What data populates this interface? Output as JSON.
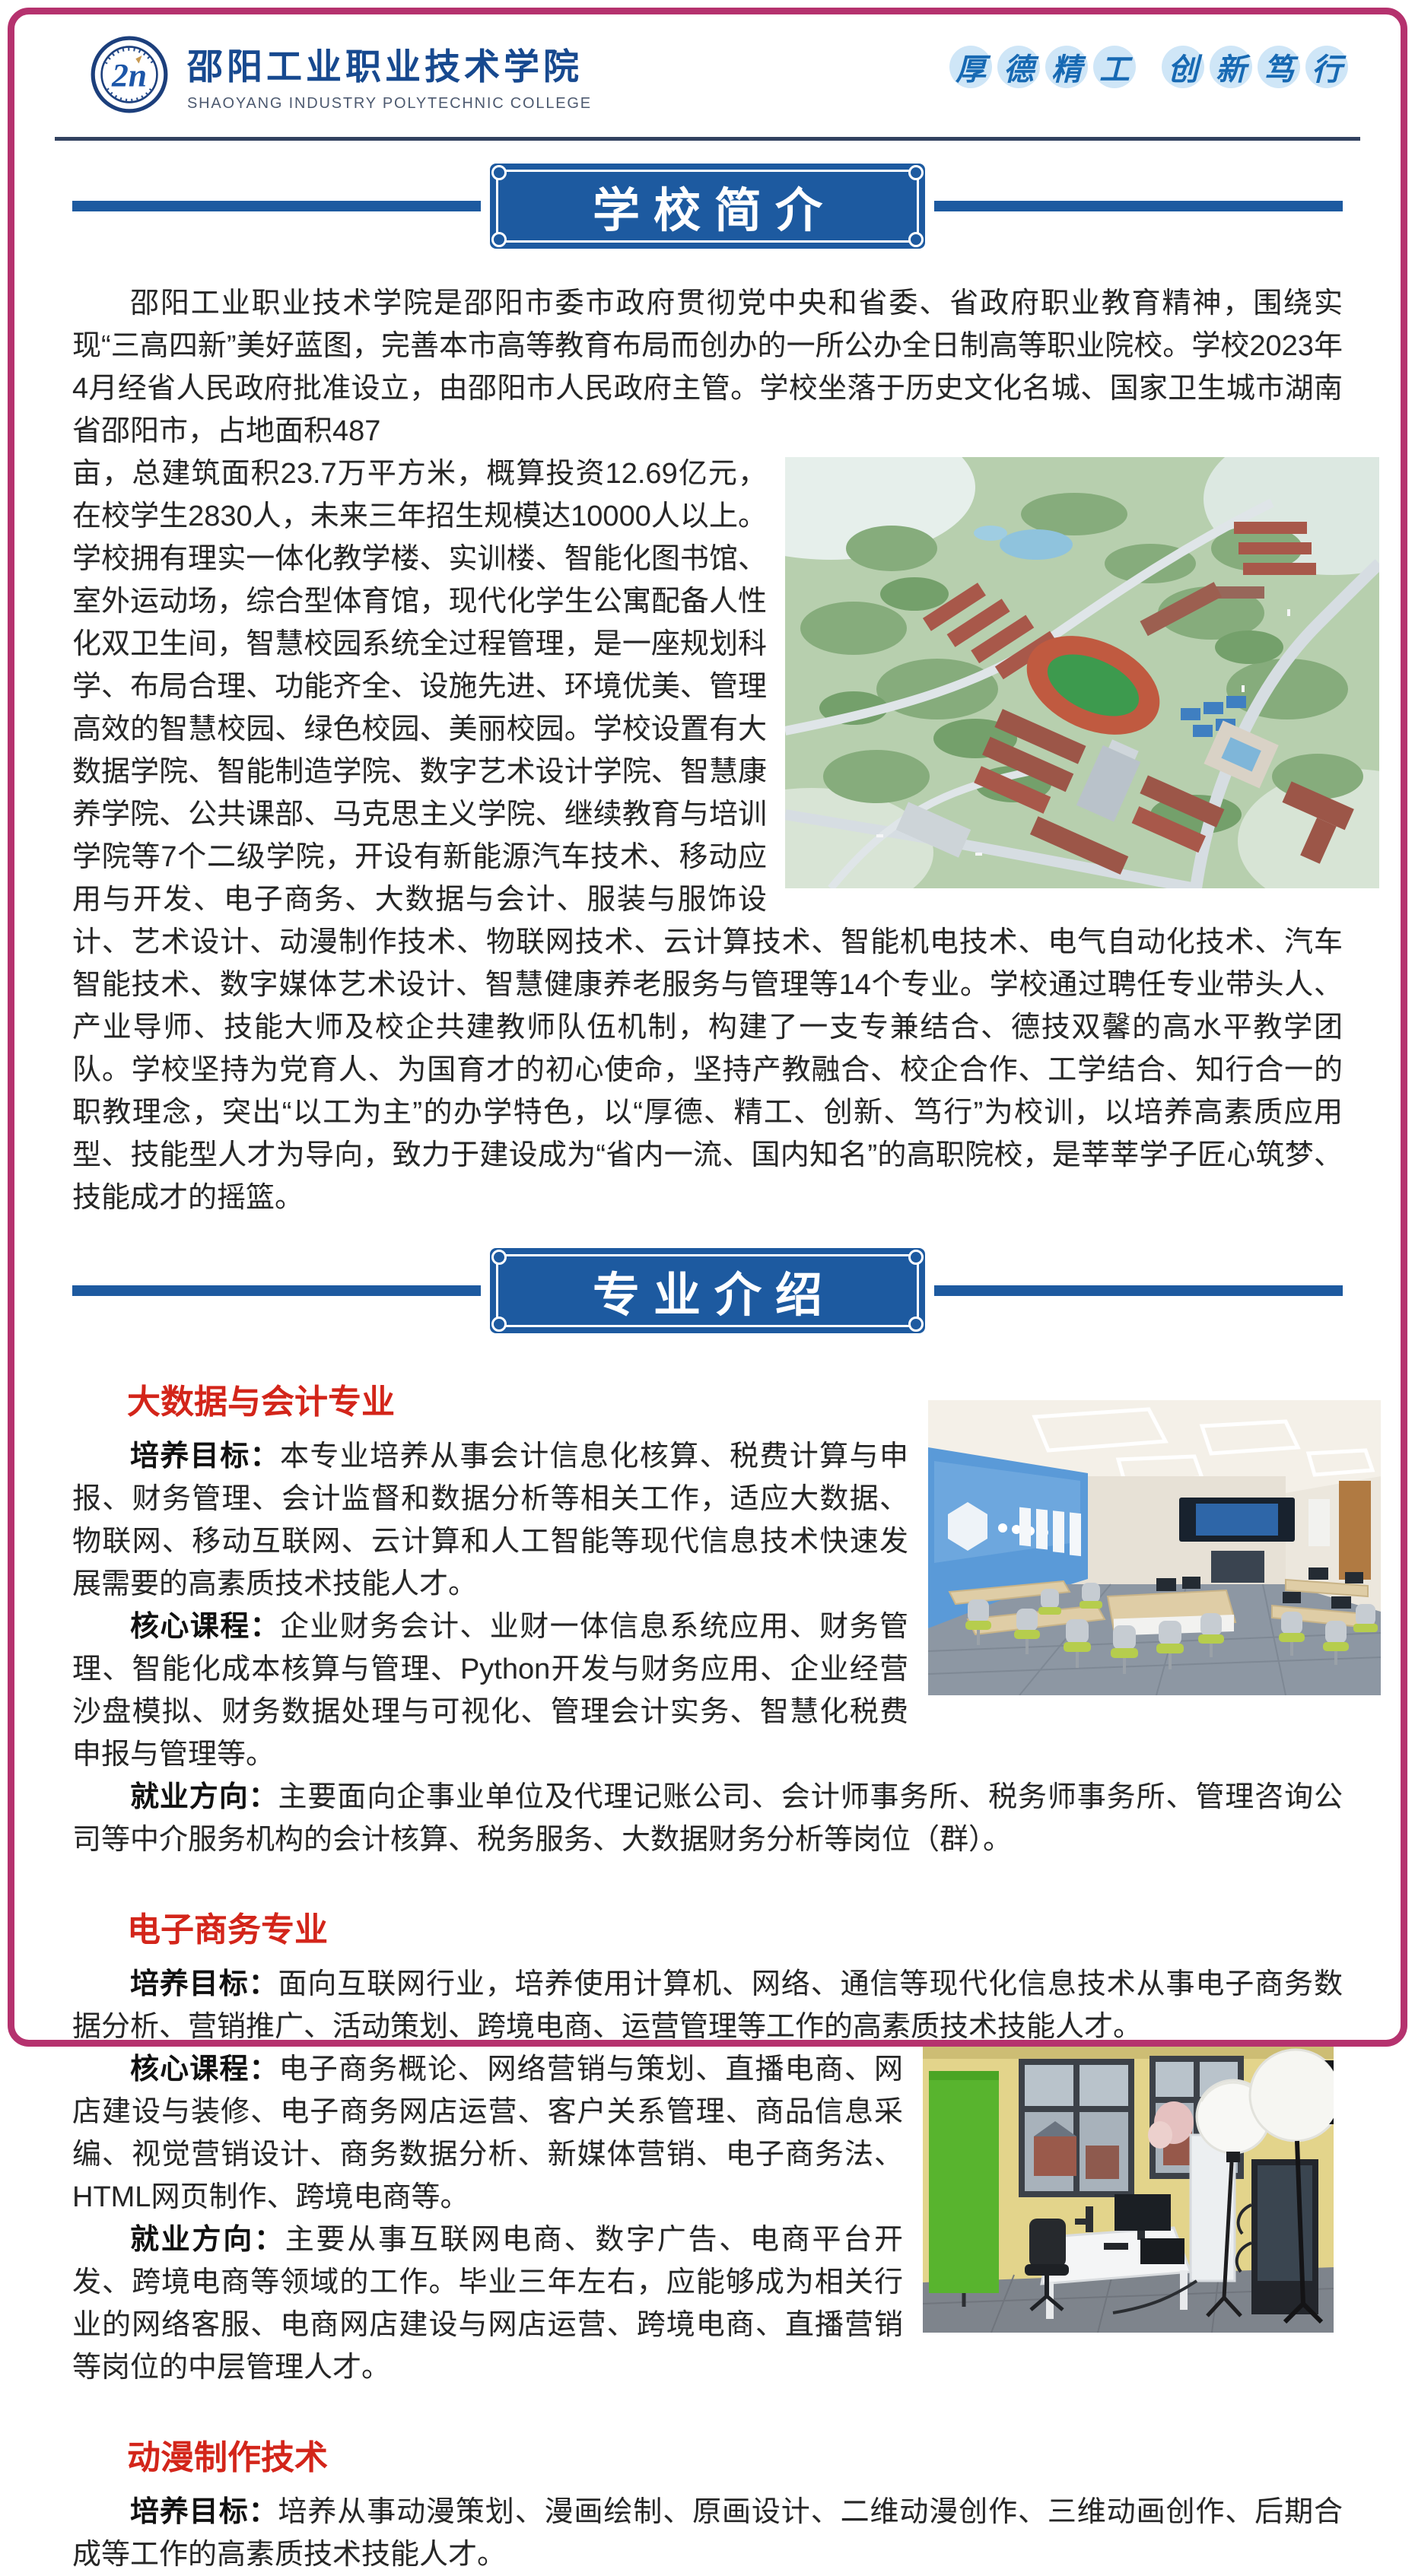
{
  "theme": {
    "page_border_pink": "#b5326e",
    "banner_blue": "#1d5aa0",
    "header_divider_navy": "#31415f",
    "major_heading_red": "#d3251a",
    "motto_text_blue": "#1769b3",
    "motto_circle_blue": "#cfe6f7",
    "college_name_blue": "#17498f"
  },
  "header": {
    "logo_icon": "college-logo-icon",
    "college_name_cn": "邵阳工业职业技术学院",
    "college_name_en": "SHAOYANG INDUSTRY POLYTECHNIC COLLEGE",
    "slogan_phrase1": "厚德精工",
    "slogan_phrase2": "创新笃行"
  },
  "photos": {
    "campus": "campus-aerial-rendering",
    "accounting": "smart-accounting-classroom-rendering",
    "studio": "ecommerce-livestream-studio-photo"
  },
  "sections": {
    "intro": {
      "banner_title": "学校简介",
      "part1": "邵阳工业职业技术学院是邵阳市委市政府贯彻党中央和省委、省政府职业教育精神，围绕实现“三高四新”美好蓝图，完善本市高等教育布局而创办的一所公办全日制高等职业院校。学校2023年4月经省人民政府批准设立，由邵阳市人民政府主管。学校坐落于历史文化名城、国家卫生城市湖南省邵阳市，占地面积487",
      "part2": "亩，总建筑面积23.7万平方米，概算投资12.69亿元，在校学生2830人，未来三年招生规模达10000人以上。学校拥有理实一体化教学楼、实训楼、智能化图书馆、室外运动场，综合型体育馆，现代化学生公寓配备人性化双卫生间，智慧校园系统全过程管理，是一座规划科学、布局合理、功能齐全、设施先进、环境优美、管理高效的智慧校园、绿色校园、美丽校园。学校设置有大数据学院、智能制造学院、数字艺术设计学院、智慧康养学院、公共课部、马克思主义学院、继续教育与培训学院等7个二级学院，开设有新能源汽车技术、移动应用与开发、电子商务、大数据与会计、服装与服饰设计、艺术设计、动漫制作技术、物联网技术、云计算技术、智能机电技术、电气自动化技术、汽车智能技术、数字媒体艺术设计、智慧健康养老服务与管理等14个专业。学校通过聘任专业带头人、产业导师、技能大师及校企共建教师队伍机制，构建了一支专兼结合、德技双馨的高水平教学团队。学校坚持为党育人、为国育才的初心使命，坚持产教融合、校企合作、工学结合、知行合一的职教理念，突出“以工为主”的办学特色，以“厚德、精工、创新、笃行”为校训，以培养高素质应用型、技能型人才为导向，致力于建设成为“省内一流、国内知名”的高职院校，是莘莘学子匠心筑梦、技能成才的摇篮。"
    },
    "majors": {
      "banner_title": "专业介绍",
      "items": [
        {
          "title": "大数据与会计专业",
          "paragraphs": [
            {
              "label": "培养目标：",
              "text": "本专业培养从事会计信息化核算、税费计算与申报、财务管理、会计监督和数据分析等相关工作，适应大数据、物联网、移动互联网、云计算和人工智能等现代信息技术快速发展需要的高素质技术技能人才。"
            },
            {
              "label": "核心课程：",
              "text": "企业财务会计、业财一体信息系统应用、财务管理、智能化成本核算与管理、Python开发与财务应用、企业经营沙盘模拟、财务数据处理与可视化、管理会计实务、智慧化税费申报与管理等。"
            },
            {
              "label": "就业方向：",
              "text": "主要面向企事业单位及代理记账公司、会计师事务所、税务师事务所、管理咨询公司等中介服务机构的会计核算、税务服务、大数据财务分析等岗位（群）。"
            }
          ]
        },
        {
          "title": "电子商务专业",
          "paragraphs": [
            {
              "label": "培养目标：",
              "text": "面向互联网行业，培养使用计算机、网络、通信等现代化信息技术从事电子商务数据分析、营销推广、活动策划、跨境电商、运营管理等工作的高素质技术技能人才。"
            },
            {
              "label": "核心课程：",
              "text": "电子商务概论、网络营销与策划、直播电商、网店建设与装修、电子商务网店运营、客户关系管理、商品信息采编、视觉营销设计、商务数据分析、新媒体营销、电子商务法、HTML网页制作、跨境电商等。"
            },
            {
              "label": "就业方向：",
              "text": "主要从事互联网电商、数字广告、电商平台开发、跨境电商等领域的工作。毕业三年左右，应能够成为相关行业的网络客服、电商网店建设与网店运营、跨境电商、直播营销等岗位的中层管理人才。"
            }
          ]
        },
        {
          "title": "动漫制作技术",
          "paragraphs": [
            {
              "label": "培养目标：",
              "text": "培养从事动漫策划、漫画绘制、原画设计、二维动漫创作、三维动画创作、后期合成等工作的高素质技术技能人才。"
            }
          ]
        }
      ]
    }
  }
}
